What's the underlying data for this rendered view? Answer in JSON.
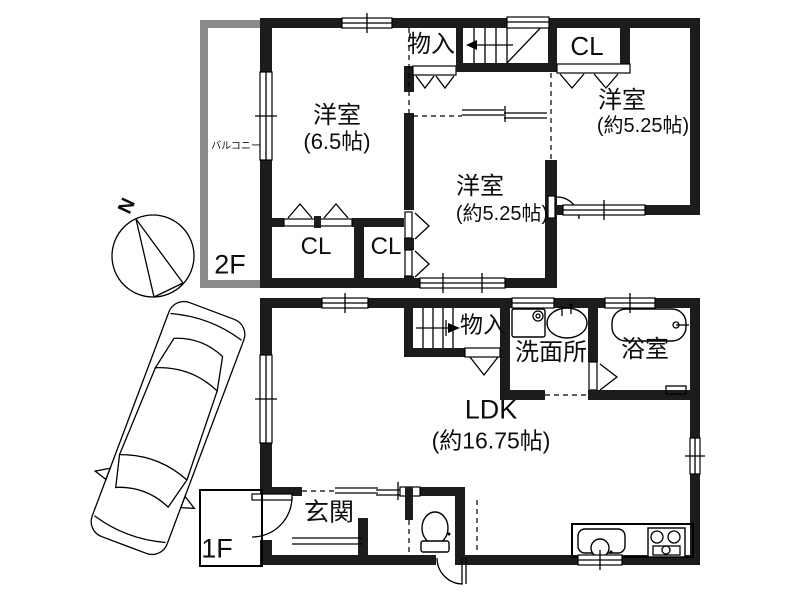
{
  "document_type": "house-floor-plan",
  "colors": {
    "wall": "#1c1c1c",
    "balcony_wall": "#8a8a8a",
    "line": "#000000",
    "background": "#ffffff"
  },
  "labels": {
    "floor2": "2F",
    "floor1": "1F",
    "room2f_west_name": "洋室",
    "room2f_west_size": "(6.5帖)",
    "room2f_mid_name": "洋室",
    "room2f_mid_size": "(約5.25帖)",
    "room2f_east_name": "洋室",
    "room2f_east_size": "(約5.25帖)",
    "closet_2f_top": "CL",
    "closet_2f_sw": "CL",
    "closet_2f_s": "CL",
    "storage_2f": "物入",
    "balcony": "バルコニー",
    "storage_1f": "物入",
    "washroom": "洗面所",
    "bathroom": "浴室",
    "ldk_name": "LDK",
    "ldk_size": "(約16.75帖)",
    "entrance": "玄関",
    "north": "N"
  },
  "floors": [
    {
      "id": "2F",
      "rooms": [
        "洋室(6.5帖)",
        "洋室(約5.25帖)",
        "洋室(約5.25帖)",
        "CL",
        "CL",
        "CL",
        "物入",
        "バルコニー"
      ]
    },
    {
      "id": "1F",
      "rooms": [
        "LDK(約16.75帖)",
        "玄関",
        "洗面所",
        "浴室",
        "物入"
      ]
    }
  ]
}
